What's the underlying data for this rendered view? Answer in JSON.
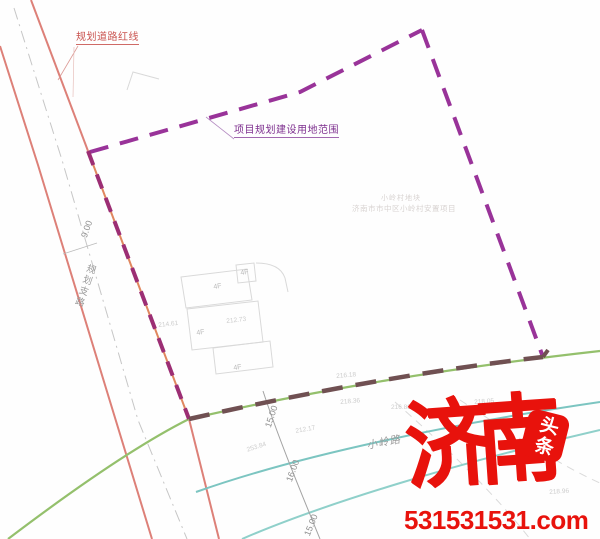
{
  "map": {
    "labels": {
      "road_redline": "规划道路红线",
      "site_boundary": "项目规划建设用地范围",
      "road_width": "9.00",
      "road_name": "规划支路",
      "dim_a": "15.00",
      "dim_b": "16.00",
      "dim_c": "15.00",
      "street_name": "小岭路",
      "caption_line1": "小岭村地块",
      "caption_line2": "济南市市中区小岭村安置项目",
      "floor": "4F",
      "elevations": [
        "214.61",
        "212.73",
        "216.18",
        "218.36",
        "253.84",
        "212.17",
        "216.88",
        "218.05",
        "218.96"
      ]
    },
    "colors": {
      "boundary_purple": "#993399",
      "boundary_overlap": "#9c2e74",
      "boundary_bottom": "#705052",
      "road_red": "#dd8078",
      "road_orange": "#e0875f",
      "green_line": "#94c06c",
      "teal_line": "#7cc5c1",
      "centerline_gray": "#c6c6c6",
      "label_red": "#c9524e",
      "label_purple": "#7d2f8e",
      "watermark_red": "#e8120c"
    }
  },
  "watermark": {
    "brand": "济南",
    "badge": "头条",
    "url": "531531531.com"
  }
}
